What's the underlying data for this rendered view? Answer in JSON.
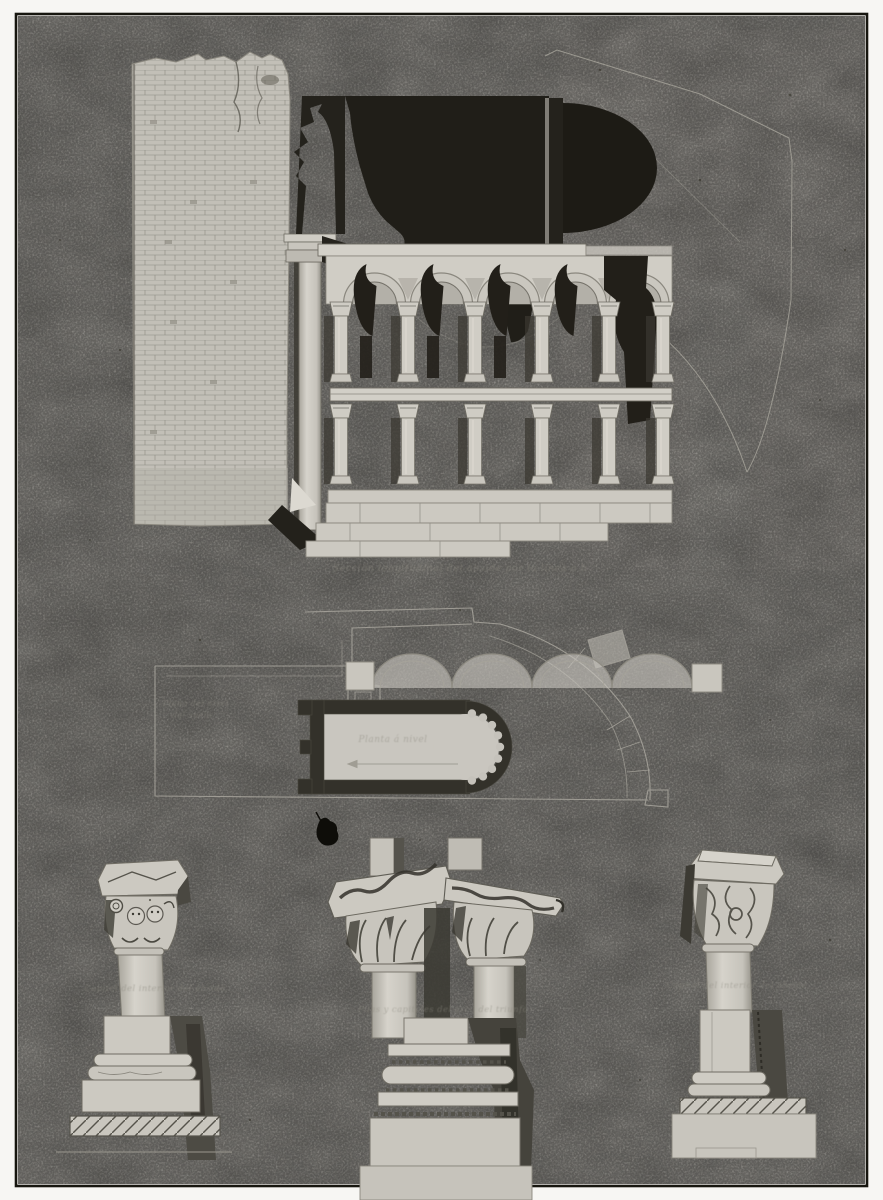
{
  "plate": {
    "paper_color": "#c5c2bb",
    "ink_color": "#1d1b15",
    "frame_color": "#17160f",
    "figures": {
      "elevation": {
        "caption": "Sección longitudinal del ábside por la línea a b"
      },
      "plan": {
        "left_label_line1": "Plano del nivel",
        "left_label_line2": "del suelo",
        "center_label": "Planta á nivel"
      },
      "capitals": {
        "left_caption": "Capitel del interior del ábside",
        "center_caption": "Pilas y capiteles del arco del triunfo",
        "right_caption": "Capitel del interior del ábside"
      }
    }
  }
}
